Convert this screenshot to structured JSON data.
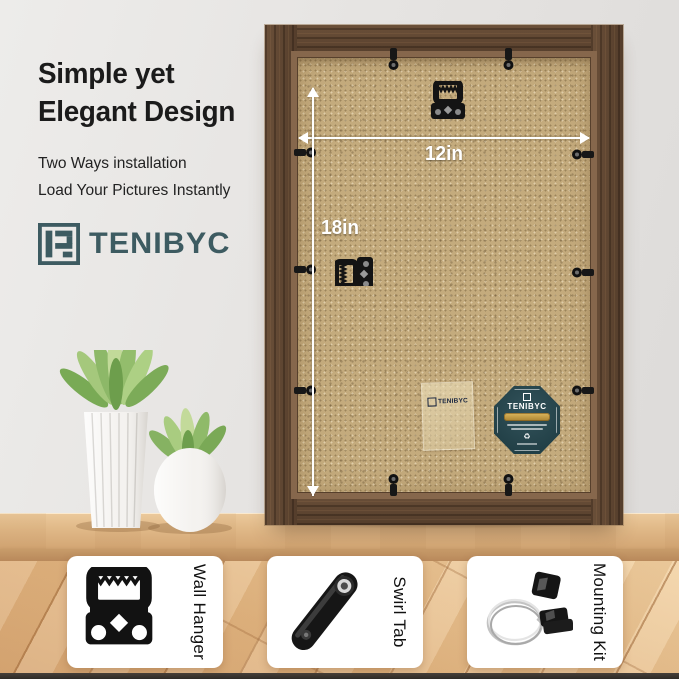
{
  "hero": {
    "headline_line1": "Simple yet",
    "headline_line2": "Elegant Design",
    "sub_line1": "Two Ways installation",
    "sub_line2": "Load Your Pictures Instantly",
    "brand": "TENIBYC"
  },
  "frame": {
    "width_label": "12in",
    "height_label": "18in",
    "sticker_brand": "TENIBYC",
    "badge_brand": "TENIBYC",
    "recycle_glyph": "♻"
  },
  "features": [
    {
      "label": "Wall Hanger"
    },
    {
      "label": "Swirl Tab"
    },
    {
      "label": "Mounting Kit"
    }
  ],
  "colors": {
    "logo_teal": "#3d5b61",
    "badge_teal": "#2c4a52",
    "badge_gold": "#c49a3f",
    "frame_wood": "#5d4634",
    "backboard_tan": "#c4ab7d",
    "annotation_white": "#ffffff"
  }
}
